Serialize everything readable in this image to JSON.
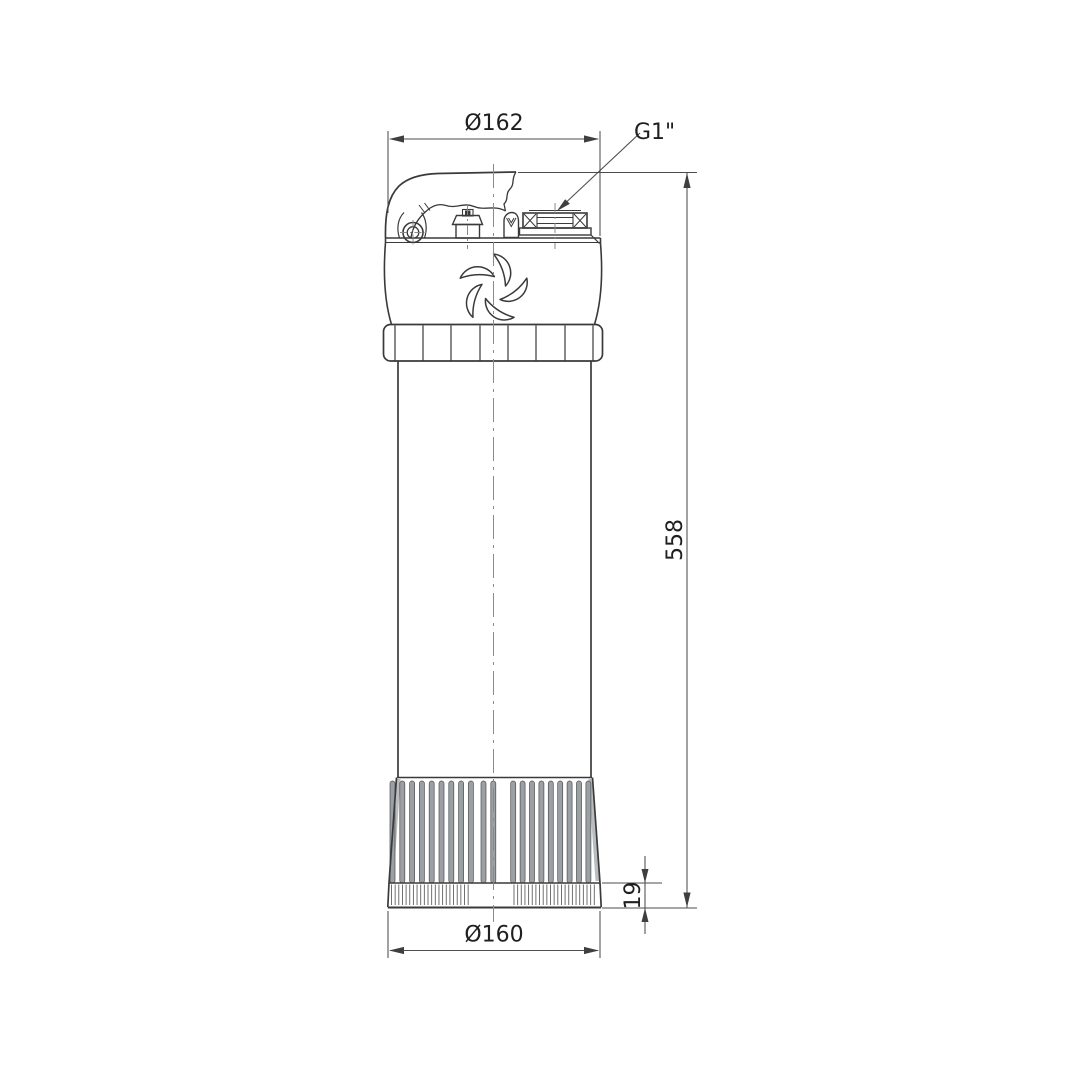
{
  "drawing": {
    "description": "technical dimensional outline drawing of a vertical submersible pump, front view",
    "labels": {
      "top_diameter": "Ø162",
      "outlet_thread": "G1\"",
      "overall_height": "558",
      "foot_band_height": "19",
      "bottom_diameter": "Ø160"
    },
    "colors": {
      "background": "#ffffff",
      "outline": "#3a3a3a",
      "dimension_line": "#4d4d4d",
      "text": "#1f1f1f",
      "strainer_slot_fill": "#9aa0a4",
      "centerline": "#8a8a8a"
    }
  }
}
